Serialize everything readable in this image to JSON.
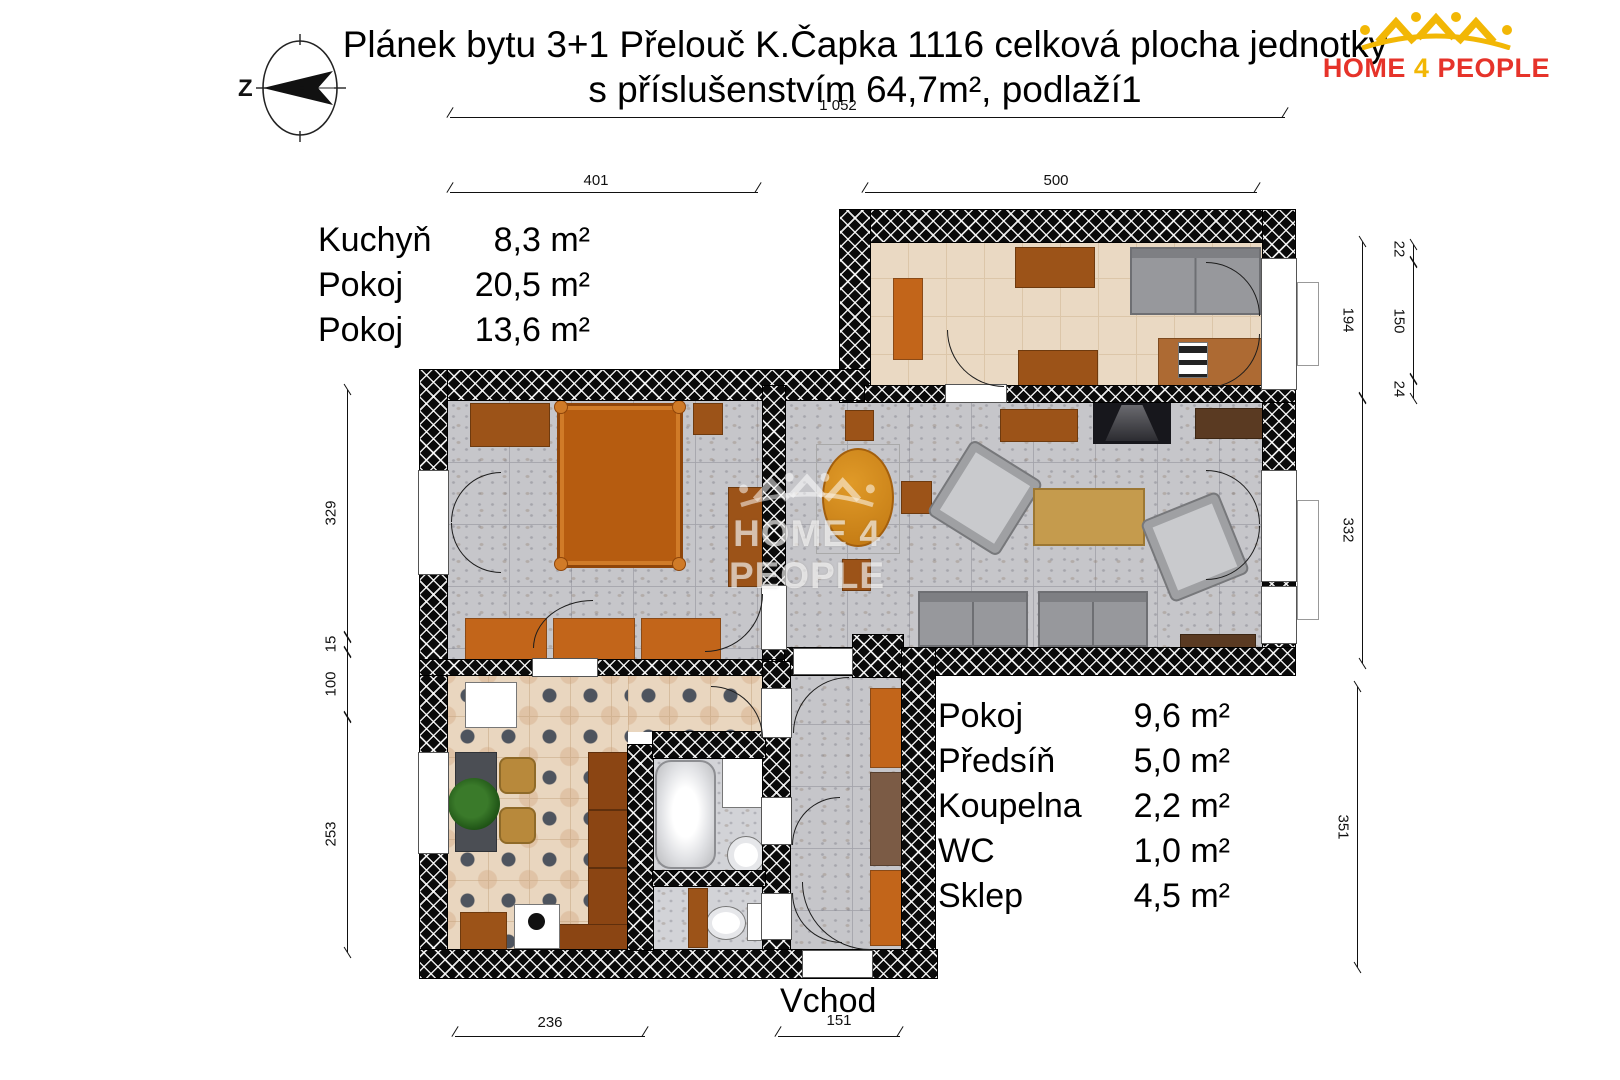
{
  "title": {
    "line1": "Plánek bytu 3+1 Přelouč K.Čapka 1116 celková plocha jednotky",
    "line2": "s příslušenstvím 64,7m², podlaží1"
  },
  "logo": {
    "word1": "HOME",
    "word2": "4",
    "word3": "PEOPLE"
  },
  "compass": {
    "direction_label": "Z"
  },
  "watermark": {
    "text": "HOME 4 PEOPLE"
  },
  "rooms_left": [
    {
      "name": "Kuchyň",
      "area": "8,3 m²"
    },
    {
      "name": "Pokoj",
      "area": "20,5 m²"
    },
    {
      "name": "Pokoj",
      "area": "13,6 m²"
    }
  ],
  "rooms_right": [
    {
      "name": "Pokoj",
      "area": "9,6 m²"
    },
    {
      "name": "Předsíň",
      "area": "5,0 m²"
    },
    {
      "name": "Koupelna",
      "area": "2,2 m²"
    },
    {
      "name": "WC",
      "area": "1,0 m²"
    },
    {
      "name": "Sklep",
      "area": "4,5 m²"
    }
  ],
  "entrance_label": "Vchod",
  "dimensions": {
    "total_width": "1 052",
    "left_block_width": "401",
    "right_block_width": "500",
    "right_outer_top": "22",
    "right_outer_mid": "150",
    "right_outer_bottom": "24",
    "right_inner_upper": "194",
    "right_inner_lower": "332",
    "right_lower": "351",
    "left_1": "329",
    "left_2": "15",
    "left_3": "100",
    "left_4": "253",
    "bottom_left": "236",
    "bottom_entrance": "151"
  },
  "colors": {
    "wall": "#0a0a0a",
    "accent_orange": "#c2651a",
    "accent_brown": "#9c5318",
    "floor_beige": "#ead9c3",
    "floor_gray": "#c6c6ca",
    "floor_kitchen_tile": "#e9d6bf",
    "logo_red": "#e6332a",
    "logo_yellow": "#f2b705"
  }
}
